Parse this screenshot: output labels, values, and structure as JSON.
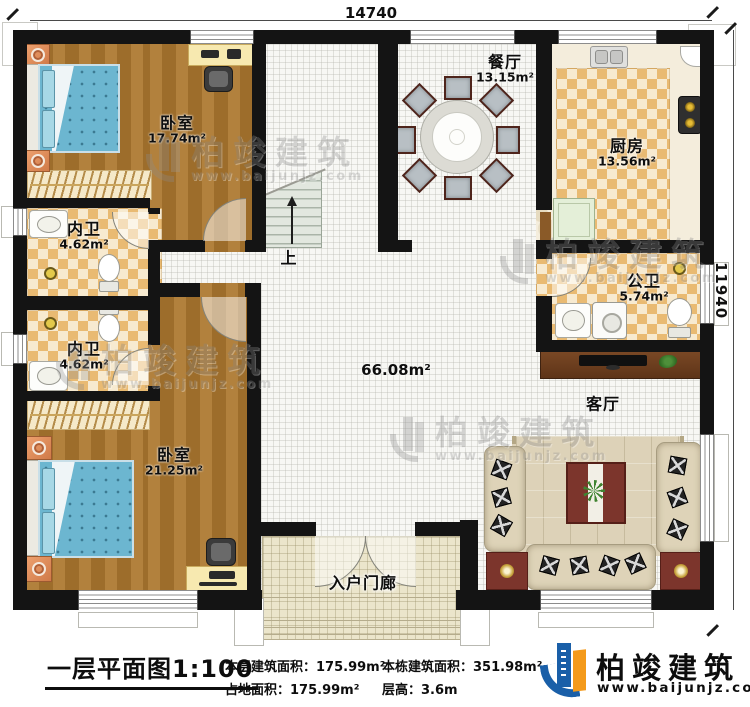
{
  "plan": {
    "dimension_top": "14740",
    "dimension_right": "11940",
    "hall_area": "66.08m²",
    "stairs_label": "上",
    "rooms": {
      "bedroom1": {
        "name": "卧室",
        "area": "17.74m²"
      },
      "inner_bath1": {
        "name": "内卫",
        "area": "4.62m²"
      },
      "inner_bath2": {
        "name": "内卫",
        "area": "4.62m²"
      },
      "bedroom2": {
        "name": "卧室",
        "area": "21.25m²"
      },
      "dining": {
        "name": "餐厅",
        "area": "13.15m²"
      },
      "kitchen": {
        "name": "厨房",
        "area": "13.56m²"
      },
      "public_bath": {
        "name": "公卫",
        "area": "5.74m²"
      },
      "living": {
        "name": "客厅"
      },
      "porch": {
        "name": "入户门廊"
      }
    }
  },
  "footer": {
    "plan_title": "一层平面图",
    "scale": "1:100",
    "stats": [
      {
        "label": "本层建筑面积：",
        "value": "175.99m²"
      },
      {
        "label": "占地面积：",
        "value": "175.99m²"
      },
      {
        "label": "本栋建筑面积：",
        "value": "351.98m²"
      },
      {
        "label": "层高：",
        "value": "3.6m"
      }
    ]
  },
  "brand": {
    "name": "柏竣建筑",
    "url": "www.baijunjz.com"
  },
  "watermark": {
    "name": "柏竣建筑",
    "url": "www.baijunjz.com"
  },
  "colors": {
    "wall": "#141414",
    "wood": "#a97a33",
    "tile_accent": "#e9ba72",
    "brand_blue": "#1a5fa8",
    "brand_orange": "#f49a1b"
  }
}
